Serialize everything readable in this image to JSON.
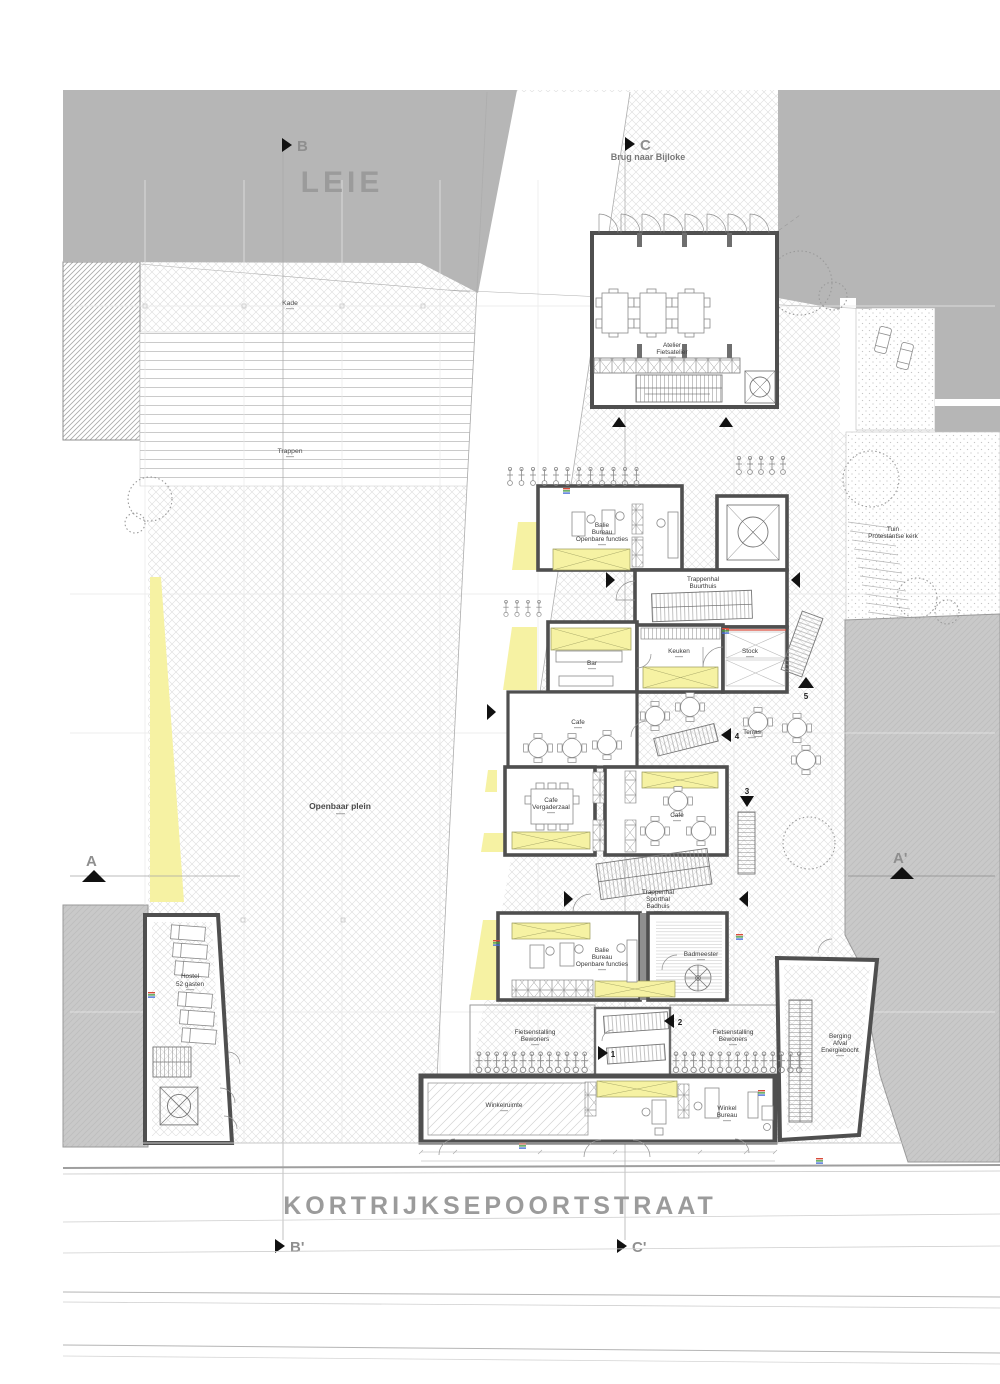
{
  "site": {
    "leie": "LEIE",
    "street": "KORTRIJKSEPOORTSTRAAT",
    "brug": "Brug naar Bijloke",
    "kade": "Kade",
    "trappen": "Trappen",
    "plein": "Openbaar plein",
    "tuin1": "Tuin",
    "tuin2": "Protestantse kerk"
  },
  "sections": {
    "a": "A",
    "a2": "A'",
    "b": "B",
    "b2": "B'",
    "c": "C",
    "c2": "C'"
  },
  "markers": {
    "m1": "1",
    "m2": "2",
    "m3": "3",
    "m4": "4",
    "m5": "5"
  },
  "rooms": {
    "atelier1": "Atelier",
    "atelier2": "Fietsatelier",
    "balie1": "Balie",
    "balie2": "Bureau",
    "balie3": "Openbare functies",
    "trap_buurt1": "Trappenhal",
    "trap_buurt2": "Buurthuis",
    "bar": "Bar",
    "keuken": "Keuken",
    "stock": "Stock",
    "cafe": "Cafe",
    "terras": "Terras",
    "vergader1": "Cafe",
    "vergader2": "Vergaderzaal",
    "trap_sport1": "Trappenhal",
    "trap_sport2": "Sporthal",
    "trap_sport3": "Badhuis",
    "balie_z1": "Balie",
    "balie_z2": "Bureau",
    "balie_z3": "Openbare functies",
    "badmeester": "Badmeester",
    "fiets1": "Fietsenstalling",
    "fiets2": "Bewoners",
    "winkelruimte": "Winkelruimte",
    "winkel1": "Winkel",
    "winkel2": "Bureau",
    "berging1": "Berging",
    "berging2": "Afval",
    "berging3": "Energiebocht",
    "hostel1": "Hostel",
    "hostel2": "52 gasten"
  },
  "colors": {
    "water": "#b6b6b6",
    "highlight": "#f6f2a3",
    "neighbor": "#c9c9c9",
    "wall": "#4f4f4f",
    "hatch": "#dcdcdc",
    "text_gray": "#9b9b9b",
    "accent_red": "#d84b3a"
  }
}
